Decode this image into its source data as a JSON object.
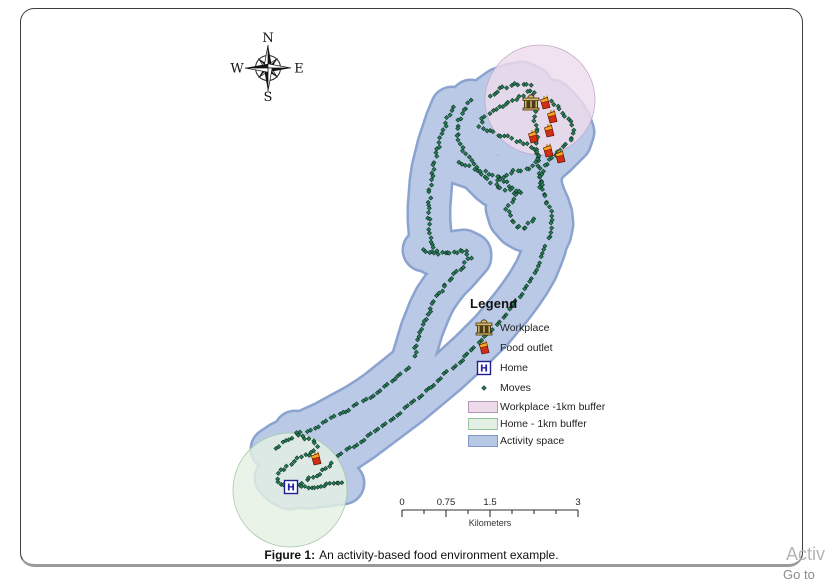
{
  "figure": {
    "caption_label": "Figure 1:",
    "caption_text": "An activity-based food environment example."
  },
  "compass": {
    "north": "N",
    "east": "E",
    "south": "S",
    "west": "W"
  },
  "legend": {
    "title": "Legend",
    "point_items": [
      {
        "icon": "workplace-icon",
        "label": "Workplace"
      },
      {
        "icon": "food-outlet-icon",
        "label": "Food outlet"
      },
      {
        "icon": "home-icon",
        "label": "Home"
      },
      {
        "icon": "moves-icon",
        "label": "Moves"
      }
    ],
    "area_items": [
      {
        "label": "Workplace -1km buffer",
        "fill": "#eedbea",
        "border": "#b099b8"
      },
      {
        "label": "Home - 1km buffer",
        "fill": "#e3efe2",
        "border": "#98c49e"
      },
      {
        "label": "Activity space",
        "fill": "#b7c8e4",
        "border": "#7f97c2"
      }
    ]
  },
  "scalebar": {
    "tick_labels": [
      "0",
      "0.75",
      "1.5",
      "3"
    ],
    "unit_label": "Kilometers"
  },
  "page_corner": {
    "partial_heading": "Activ",
    "partial_link": "Go to"
  },
  "map": {
    "colors": {
      "activity_fill": "#b9c9e6",
      "activity_border": "#8ba3cf",
      "workplace_buffer_fill": "#eedcec",
      "workplace_buffer_border": "#c3a8ce",
      "home_buffer_fill": "#e4f0e3",
      "home_buffer_border": "#a6caa9",
      "move_dot": "#23835c",
      "move_dot_border": "#12301f"
    },
    "workplace_buffer": {
      "cx": 540,
      "cy": 100,
      "r": 55
    },
    "home_buffer": {
      "cx": 290,
      "cy": 490,
      "r": 57
    },
    "workplace_pos": {
      "x": 531,
      "y": 103
    },
    "home_pos": {
      "x": 291,
      "y": 487
    },
    "food_outlet_positions": [
      [
        545,
        103
      ],
      [
        552,
        117
      ],
      [
        549,
        131
      ],
      [
        533,
        137
      ],
      [
        548,
        151
      ],
      [
        560,
        157
      ],
      [
        316,
        459
      ]
    ],
    "trails": [
      {
        "name": "workplace-loop",
        "step": 4,
        "pts": [
          [
            490,
            96
          ],
          [
            500,
            89
          ],
          [
            511,
            85
          ],
          [
            522,
            83
          ],
          [
            531,
            87
          ],
          [
            525,
            95
          ],
          [
            514,
            100
          ],
          [
            503,
            105
          ],
          [
            493,
            111
          ],
          [
            484,
            118
          ],
          [
            479,
            126
          ],
          [
            487,
            131
          ],
          [
            497,
            134
          ],
          [
            508,
            137
          ],
          [
            519,
            141
          ],
          [
            529,
            146
          ],
          [
            536,
            153
          ],
          [
            539,
            162
          ],
          [
            531,
            167
          ],
          [
            520,
            170
          ],
          [
            509,
            173
          ],
          [
            500,
            178
          ],
          [
            495,
            186
          ],
          [
            503,
            190
          ],
          [
            513,
            192
          ],
          [
            523,
            193
          ]
        ]
      },
      {
        "name": "workplace-west-arc",
        "step": 4,
        "pts": [
          [
            471,
            101
          ],
          [
            464,
            110
          ],
          [
            459,
            120
          ],
          [
            457,
            131
          ],
          [
            459,
            142
          ],
          [
            464,
            152
          ],
          [
            470,
            161
          ],
          [
            477,
            169
          ],
          [
            484,
            176
          ],
          [
            491,
            183
          ]
        ]
      },
      {
        "name": "workplace-vertical",
        "step": 4,
        "pts": [
          [
            533,
            93
          ],
          [
            534,
            105
          ],
          [
            535,
            117
          ],
          [
            536,
            129
          ],
          [
            537,
            141
          ],
          [
            538,
            153
          ],
          [
            539,
            165
          ],
          [
            540,
            177
          ],
          [
            541,
            189
          ]
        ]
      },
      {
        "name": "east-hook",
        "step": 4,
        "pts": [
          [
            552,
            101
          ],
          [
            559,
            108
          ],
          [
            565,
            115
          ],
          [
            570,
            123
          ],
          [
            573,
            132
          ],
          [
            570,
            141
          ],
          [
            563,
            148
          ],
          [
            556,
            155
          ],
          [
            549,
            161
          ],
          [
            543,
            168
          ],
          [
            540,
            177
          ],
          [
            541,
            187
          ],
          [
            544,
            196
          ],
          [
            548,
            205
          ],
          [
            551,
            214
          ],
          [
            552,
            224
          ],
          [
            550,
            234
          ],
          [
            546,
            242
          ]
        ]
      },
      {
        "name": "commute-descent",
        "step": 4,
        "pts": [
          [
            452,
            108
          ],
          [
            447,
            120
          ],
          [
            443,
            132
          ],
          [
            439,
            144
          ],
          [
            436,
            156
          ],
          [
            433,
            168
          ],
          [
            431,
            181
          ],
          [
            430,
            194
          ],
          [
            429,
            207
          ],
          [
            429,
            220
          ],
          [
            430,
            233
          ],
          [
            431,
            246
          ],
          [
            434,
            254
          ]
        ]
      },
      {
        "name": "junction",
        "step": 3,
        "pts": [
          [
            424,
            250
          ],
          [
            432,
            252
          ],
          [
            440,
            253
          ],
          [
            448,
            253
          ],
          [
            456,
            252
          ],
          [
            464,
            251
          ],
          [
            470,
            254
          ]
        ]
      },
      {
        "name": "mid-descent",
        "step": 4,
        "pts": [
          [
            470,
            257
          ],
          [
            463,
            265
          ],
          [
            456,
            273
          ],
          [
            448,
            281
          ],
          [
            441,
            290
          ],
          [
            435,
            299
          ],
          [
            430,
            309
          ],
          [
            426,
            319
          ],
          [
            422,
            329
          ],
          [
            419,
            339
          ],
          [
            416,
            349
          ],
          [
            413,
            359
          ]
        ]
      },
      {
        "name": "left-corridor",
        "step": 9,
        "pts": [
          [
            408,
            367
          ],
          [
            398,
            375
          ],
          [
            388,
            383
          ],
          [
            378,
            391
          ],
          [
            368,
            398
          ],
          [
            357,
            405
          ],
          [
            346,
            411
          ],
          [
            335,
            417
          ],
          [
            324,
            423
          ],
          [
            313,
            428
          ],
          [
            302,
            433
          ],
          [
            291,
            438
          ],
          [
            281,
            443
          ],
          [
            272,
            449
          ]
        ]
      },
      {
        "name": "right-corridor",
        "step": 9,
        "pts": [
          [
            338,
            456
          ],
          [
            350,
            448
          ],
          [
            362,
            440
          ],
          [
            374,
            431
          ],
          [
            386,
            422
          ],
          [
            398,
            413
          ],
          [
            410,
            404
          ],
          [
            422,
            394
          ],
          [
            434,
            384
          ],
          [
            446,
            374
          ],
          [
            458,
            363
          ],
          [
            470,
            352
          ],
          [
            481,
            341
          ],
          [
            492,
            330
          ],
          [
            502,
            318
          ],
          [
            512,
            306
          ],
          [
            521,
            294
          ],
          [
            529,
            282
          ],
          [
            536,
            270
          ],
          [
            541,
            258
          ],
          [
            545,
            247
          ]
        ]
      },
      {
        "name": "cross-trail",
        "step": 4,
        "pts": [
          [
            459,
            163
          ],
          [
            468,
            166
          ],
          [
            477,
            169
          ],
          [
            486,
            172
          ],
          [
            495,
            176
          ],
          [
            504,
            181
          ],
          [
            512,
            186
          ],
          [
            519,
            192
          ],
          [
            513,
            200
          ],
          [
            507,
            208
          ],
          [
            510,
            218
          ],
          [
            517,
            226
          ],
          [
            524,
            230
          ],
          [
            530,
            224
          ],
          [
            536,
            218
          ]
        ]
      },
      {
        "name": "home-squiggle",
        "step": 4,
        "pts": [
          [
            295,
            432
          ],
          [
            303,
            437
          ],
          [
            311,
            441
          ],
          [
            318,
            446
          ],
          [
            312,
            452
          ],
          [
            304,
            456
          ],
          [
            296,
            460
          ],
          [
            288,
            465
          ],
          [
            281,
            471
          ],
          [
            276,
            478
          ],
          [
            282,
            484
          ],
          [
            290,
            488
          ],
          [
            298,
            485
          ],
          [
            306,
            481
          ],
          [
            314,
            477
          ],
          [
            322,
            472
          ],
          [
            329,
            467
          ],
          [
            335,
            461
          ]
        ]
      },
      {
        "name": "home-east",
        "step": 6,
        "pts": [
          [
            303,
            487
          ],
          [
            311,
            487
          ],
          [
            319,
            486
          ],
          [
            327,
            485
          ],
          [
            335,
            484
          ],
          [
            343,
            483
          ]
        ]
      }
    ]
  }
}
